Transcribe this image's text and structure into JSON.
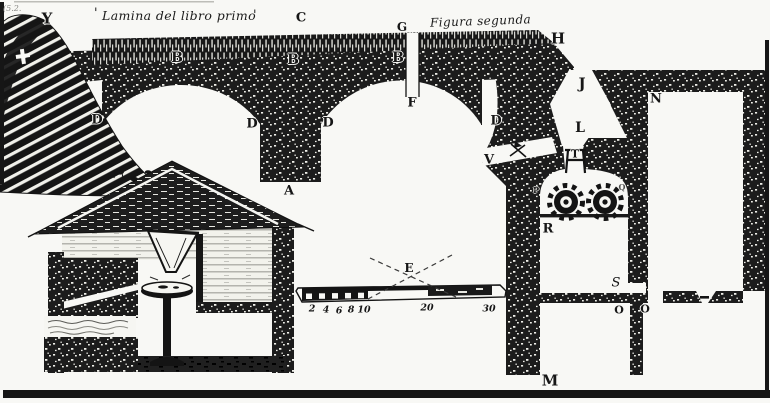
{
  "figure": {
    "caption_left": "Lamina del libro primo",
    "caption_right": "Figura segunda",
    "corner_note": "(5.2.",
    "tick_left": "'",
    "tick_right": "'"
  },
  "labels": {
    "Y": "Y",
    "C": "C",
    "G": "G",
    "H": "H",
    "B1": "B",
    "B2": "B",
    "B3": "B",
    "D1": "D",
    "D2": "D",
    "D3": "D",
    "D4": "D",
    "F": "F",
    "A": "A",
    "E": "E",
    "J": "J",
    "N": "N",
    "L": "L",
    "V": "V",
    "T": "T",
    "P": "P",
    "Q": "Q",
    "R": "R",
    "S": "S",
    "O1": "O",
    "O2": "O",
    "M": "M"
  },
  "scale_bar": {
    "ticks": {
      "t2": "2",
      "t4": "4",
      "t6": "6",
      "t8": "8",
      "t10": "10",
      "t20": "20",
      "t30": "30"
    }
  },
  "colors": {
    "ink": "#161616",
    "paper": "#f8f8f5"
  }
}
